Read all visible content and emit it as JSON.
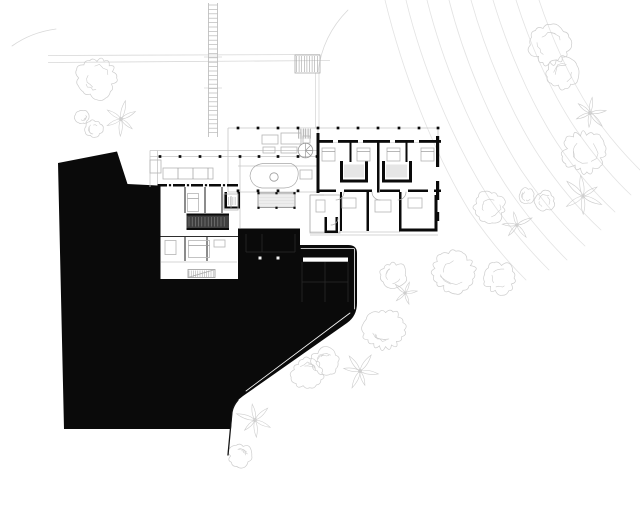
{
  "meta": {
    "kind": "architectural-site-plan",
    "width": 640,
    "height": 512
  },
  "colors": {
    "bg": "#ffffff",
    "terrain": "#0a0a0a",
    "wall": "#0a0a0a",
    "light_line": "#c6c6c6",
    "medium_line": "#2e2e2e",
    "furniture": "#b5b5b5",
    "vegetation": "#cdcdcd",
    "contour": "#e3e3e3",
    "site_line": "#d8d8d8",
    "hatch_dark": "#3f3f3f"
  },
  "contours": {
    "paths": [
      "M385,0 C402,70 432,150 470,212 C492,244 512,266 526,280",
      "M406,0 C422,66 452,140 489,198 C511,230 533,254 549,270",
      "M427,0 C442,60 470,130 505,184 C529,220 553,246 567,260",
      "M449,0 C463,55 489,120 521,170 C546,207 571,233 585,246",
      "M471,0 C485,50 509,110 539,156 C563,192 587,217 601,230",
      "M493,0 C507,46 529,100 557,143 C579,176 601,199 615,212",
      "M516,0 C529,41 549,89 575,128 C596,159 617,182 631,195",
      "M539,0 C551,36 569,77 591,111 C609,138 627,157 640,170"
    ]
  },
  "site": {
    "lines": [
      [
        48,
        55.5,
        320,
        54.5
      ],
      [
        48,
        62.5,
        330,
        60.5
      ],
      [
        204,
        57,
        222,
        57
      ],
      [
        204,
        88,
        222,
        88
      ],
      [
        315.5,
        73,
        315.5,
        127.5
      ],
      [
        319,
        73,
        319,
        127.5
      ]
    ],
    "paths": [
      "M318,72 C321,47 331,27 348,10",
      "M12,46 C26,36 41,31 56,29"
    ],
    "ladder": {
      "x1": 208.5,
      "x2": 217.5,
      "y1": 3,
      "y2": 137,
      "step": 4.4
    },
    "stair_rect": [
      295,
      55,
      25,
      18
    ],
    "stair_hatch": {
      "x": 296.5,
      "y": 56,
      "w": 22,
      "h": 16,
      "step": 2.6,
      "dir": "v",
      "stroke": "#a5a5a5",
      "width": 0.6
    }
  },
  "vegetation": {
    "canopies": [
      [
        97,
        78,
        20,
        1
      ],
      [
        82,
        117,
        7,
        2
      ],
      [
        94,
        129,
        9,
        3
      ],
      [
        550,
        45,
        20,
        4
      ],
      [
        563,
        73,
        16,
        5
      ],
      [
        585,
        152,
        21,
        6
      ],
      [
        490,
        207,
        16,
        7
      ],
      [
        527,
        196,
        8,
        8
      ],
      [
        545,
        201,
        10,
        9
      ],
      [
        393,
        275,
        13,
        10
      ],
      [
        454,
        272,
        21,
        11
      ],
      [
        500,
        278,
        16,
        12
      ],
      [
        384,
        330,
        21,
        13
      ],
      [
        325,
        362,
        14,
        14
      ],
      [
        308,
        373,
        16,
        15
      ],
      [
        240,
        456,
        12,
        16
      ]
    ],
    "stars": [
      [
        121,
        119,
        17,
        6,
        21
      ],
      [
        590,
        113,
        17,
        6,
        22
      ],
      [
        583,
        196,
        20,
        6,
        23
      ],
      [
        517,
        225,
        15,
        5,
        24
      ],
      [
        405,
        293,
        13,
        5,
        25
      ],
      [
        360,
        371,
        17,
        6,
        26
      ],
      [
        255,
        420,
        18,
        6,
        27
      ]
    ]
  },
  "terrain": {
    "outline": "M58,163 L117,151.5 L127.5,184 L157.5,185.5 L157.5,282.5 L238,282.5 L238,228.5 L300,228.5 L300,245 L348,245 Q357,245 357,253 L357,303 Q357,316 347,323 L243,396 Q234,402.5 232.5,409 L231,429 L64,429 Z",
    "edge_paths": [
      [
        "M238,400 Q233,406 232,412 L228,455",
        "#141414",
        1.3
      ],
      [
        "M350,313 L246,391",
        "#fafafa",
        0.8
      ],
      [
        "M354.6,249 L354.6,309",
        "#fafafa",
        0.8
      ],
      [
        "M301,248.6 L354,248.6",
        "#fafafa",
        0.8
      ]
    ],
    "white_rects": [
      [
        303,
        257.5,
        45,
        4.2,
        "#ffffff"
      ],
      [
        258.5,
        256.5,
        3,
        3,
        "#f2f2f2"
      ],
      [
        276.5,
        256.5,
        3,
        3,
        "#f2f2f2"
      ]
    ],
    "faint_lines": [
      [
        302,
        262,
        302,
        302
      ],
      [
        325,
        262,
        325,
        302
      ],
      [
        348,
        262,
        348,
        302
      ],
      [
        302,
        282,
        348,
        282
      ],
      [
        246,
        234,
        246,
        252
      ],
      [
        295,
        234,
        295,
        252
      ],
      [
        262,
        234,
        262,
        252
      ],
      [
        246,
        252,
        295,
        252
      ]
    ]
  },
  "building": {
    "light_lines": [
      [
        228,
        128,
        440,
        128
      ],
      [
        150,
        150.5,
        318,
        150.5
      ],
      [
        150,
        156.5,
        318,
        156.5
      ],
      [
        228,
        192,
        318,
        192
      ],
      [
        238,
        166,
        318,
        166
      ],
      [
        228,
        128,
        228,
        192
      ],
      [
        150,
        150.5,
        150,
        187
      ],
      [
        157.5,
        150.5,
        157.5,
        184
      ],
      [
        240,
        156.5,
        240,
        228
      ],
      [
        310,
        235,
        438,
        235
      ],
      [
        318,
        128,
        318,
        140
      ],
      [
        438,
        128,
        438,
        140
      ],
      [
        310,
        195,
        310,
        232
      ],
      [
        310,
        195,
        324,
        195
      ],
      [
        310,
        232,
        400,
        232
      ],
      [
        161,
        262,
        237,
        262
      ]
    ],
    "medium_lines": [
      [
        185,
        187,
        185,
        213
      ],
      [
        205,
        187,
        205,
        213
      ],
      [
        222,
        187,
        222,
        213
      ],
      [
        158,
        236.5,
        238,
        236.5
      ],
      [
        185,
        236.5,
        185,
        261
      ],
      [
        207,
        236.5,
        207,
        261
      ]
    ],
    "fills": [
      [
        186.5,
        215.5,
        42.5,
        12.5,
        "#3f3f3f"
      ],
      [
        258,
        193,
        37,
        14.5,
        "#ededed"
      ],
      [
        344,
        164.5,
        20,
        13,
        "#e6e6e6"
      ],
      [
        386,
        164.5,
        21,
        13,
        "#e6e6e6"
      ],
      [
        298,
        128,
        13,
        11,
        "#f0f0f0"
      ]
    ],
    "walls": [
      [
        318,
        140,
        123,
        2.8
      ],
      [
        316.5,
        133,
        3,
        60
      ],
      [
        436,
        136,
        3.2,
        31
      ],
      [
        436,
        181,
        3.2,
        19
      ],
      [
        436,
        212,
        3.2,
        9
      ],
      [
        377,
        142.5,
        2.5,
        50
      ],
      [
        349.5,
        142.5,
        2,
        19.5
      ],
      [
        405.5,
        142.5,
        2,
        19.5
      ],
      [
        340,
        161,
        3,
        21.5
      ],
      [
        365,
        161,
        3,
        21.5
      ],
      [
        340,
        179.5,
        28,
        3
      ],
      [
        382,
        161,
        3,
        21.5
      ],
      [
        409,
        161,
        3,
        21.5
      ],
      [
        382,
        179.5,
        30,
        3
      ],
      [
        318,
        189.5,
        18,
        2.5
      ],
      [
        344,
        189.5,
        28,
        2.5
      ],
      [
        380,
        189.5,
        20,
        2.5
      ],
      [
        408,
        189.5,
        20,
        2.5
      ],
      [
        434,
        189.5,
        7,
        2.5
      ],
      [
        340,
        192,
        2,
        39
      ],
      [
        366.5,
        192,
        2.5,
        39
      ],
      [
        399,
        192,
        2.5,
        36.5
      ],
      [
        434.5,
        195,
        3,
        36
      ],
      [
        399,
        228.5,
        38.5,
        3
      ],
      [
        324.5,
        217,
        2.5,
        16
      ],
      [
        335.5,
        217,
        2.5,
        16
      ],
      [
        324.5,
        230.5,
        13.5,
        2.5
      ],
      [
        157.5,
        184,
        80.5,
        2.5
      ],
      [
        157.5,
        184,
        3,
        98.5
      ],
      [
        160.5,
        279,
        77.5,
        3.5
      ],
      [
        186.5,
        213.5,
        42.5,
        2
      ],
      [
        186.5,
        228,
        42.5,
        2
      ],
      [
        224.5,
        192,
        2.5,
        16.5
      ],
      [
        237.5,
        192,
        2.5,
        16.5
      ],
      [
        224.5,
        206.5,
        15.5,
        2
      ]
    ],
    "white_slits": [
      [
        333,
        140,
        5,
        2.8
      ],
      [
        358,
        140,
        5,
        2.8
      ],
      [
        390,
        140,
        5,
        2.8
      ],
      [
        414,
        140,
        5,
        2.8
      ],
      [
        167,
        184,
        6,
        2.5
      ],
      [
        185,
        184,
        6,
        2.5
      ],
      [
        203,
        184,
        6,
        2.5
      ],
      [
        221,
        184,
        6,
        2.5
      ]
    ],
    "hatches": [
      {
        "x": 298.5,
        "y": 128.5,
        "w": 12,
        "h": 10,
        "step": 2.4,
        "dir": "v",
        "stroke": "#9a9a9a",
        "width": 0.6
      },
      {
        "x": 189,
        "y": 217,
        "w": 38,
        "h": 9.5,
        "step": 3.2,
        "dir": "v",
        "stroke": "#858585",
        "width": 0.6
      },
      {
        "x": 189,
        "y": 270.5,
        "w": 25,
        "h": 6.5,
        "step": 2.2,
        "dir": "v",
        "stroke": "#999999",
        "width": 0.5
      },
      {
        "x": 228.5,
        "y": 197,
        "w": 8,
        "h": 8,
        "step": 2.2,
        "dir": "v",
        "stroke": "#999999",
        "width": 0.5
      },
      {
        "x": 259,
        "y": 194.5,
        "w": 35,
        "h": 12,
        "step": 3,
        "dir": "h",
        "stroke": "#dcdcdc",
        "width": 0.5
      }
    ],
    "outline_rects": [
      [
        258,
        193,
        37,
        14.5,
        "#888888",
        0.8
      ],
      [
        188,
        269.5,
        27,
        8,
        "#999999",
        0.8
      ],
      [
        310,
        195,
        30,
        38,
        "#aaaaaa",
        0.7
      ]
    ],
    "furniture_rects": [
      [
        262,
        135,
        16,
        9
      ],
      [
        281,
        133,
        20,
        11
      ],
      [
        303,
        136,
        7,
        7
      ],
      [
        263,
        147,
        12,
        6
      ],
      [
        281,
        147,
        16,
        6
      ],
      [
        300,
        170,
        12,
        9
      ],
      [
        163,
        168,
        50,
        11
      ],
      [
        150,
        160,
        11,
        13
      ],
      [
        187.5,
        193.5,
        11,
        18
      ],
      [
        224,
        194,
        14,
        16
      ],
      [
        188.5,
        240.5,
        21,
        17
      ],
      [
        165,
        240.5,
        11,
        14
      ],
      [
        214,
        240,
        11,
        7
      ],
      [
        322,
        148,
        13,
        13
      ],
      [
        357,
        148,
        13,
        13
      ],
      [
        387,
        148,
        13,
        13
      ],
      [
        421,
        148,
        13,
        13
      ],
      [
        342,
        198,
        14,
        10
      ],
      [
        375,
        200,
        16,
        12
      ],
      [
        408,
        198,
        14,
        10
      ],
      [
        316,
        200,
        9,
        12
      ]
    ],
    "furniture_lines": [
      [
        178,
        168,
        178,
        179
      ],
      [
        193,
        168,
        193,
        179
      ],
      [
        208,
        168,
        208,
        179
      ],
      [
        187.5,
        198.5,
        198.5,
        198.5
      ],
      [
        188.5,
        245.5,
        209.5,
        245.5
      ],
      [
        231,
        196,
        231,
        208
      ],
      [
        322,
        151.5,
        335,
        151.5
      ],
      [
        357,
        151.5,
        370,
        151.5
      ],
      [
        387,
        151.5,
        400,
        151.5
      ],
      [
        421,
        151.5,
        434,
        151.5
      ],
      [
        305.5,
        150.5,
        305.5,
        143.2
      ],
      [
        305.5,
        150.5,
        310.7,
        145.3
      ],
      [
        305.5,
        150.5,
        312.8,
        150.5
      ],
      [
        305.5,
        150.5,
        310.7,
        155.7
      ],
      [
        305.5,
        150.5,
        305.5,
        157.8
      ]
    ],
    "furniture_paths": [
      "M250,176 Q251,165 263,163.5 L291,163.5 Q299.5,167 298,176 Q296.5,187.5 284,188 L262,188 Q251.5,186.5 250,176 Z",
      "M344,192 A8,8 0 0 1 336,200",
      "M372,192 A8,8 0 0 0 380,200",
      "M406,192 A8,8 0 0 1 398,200",
      "M338,218 A7,7 0 0 1 331,225",
      "M188,277.5 L215,269.5"
    ],
    "circles": [
      [
        274,
        177,
        4.2
      ],
      [
        305.5,
        150.5,
        7.3
      ]
    ],
    "columns": {
      "size": 2.7,
      "points": [
        [
          238,
          128
        ],
        [
          258,
          128
        ],
        [
          278,
          128
        ],
        [
          298,
          128
        ],
        [
          318,
          128
        ],
        [
          338,
          128
        ],
        [
          358,
          128
        ],
        [
          378,
          128
        ],
        [
          399,
          128
        ],
        [
          419,
          128
        ],
        [
          438,
          128
        ],
        [
          160,
          156.5
        ],
        [
          180,
          156.5
        ],
        [
          200,
          156.5
        ],
        [
          220,
          156.5
        ],
        [
          240,
          156.5
        ],
        [
          259,
          156.5
        ],
        [
          278,
          156.5
        ],
        [
          298,
          156.5
        ],
        [
          317,
          156.5
        ],
        [
          238,
          190.8
        ],
        [
          258,
          190.8
        ],
        [
          278,
          190.8
        ],
        [
          298,
          190.8
        ]
      ]
    },
    "columns_small": {
      "size": 2.2,
      "points": [
        [
          258.5,
          193.2
        ],
        [
          276.5,
          193.2
        ],
        [
          294.5,
          193.2
        ],
        [
          258.5,
          207.8
        ],
        [
          276.5,
          207.8
        ],
        [
          294.5,
          207.8
        ],
        [
          170,
          185.2
        ],
        [
          188,
          185.2
        ],
        [
          206,
          185.2
        ],
        [
          224,
          185.2
        ]
      ]
    }
  }
}
